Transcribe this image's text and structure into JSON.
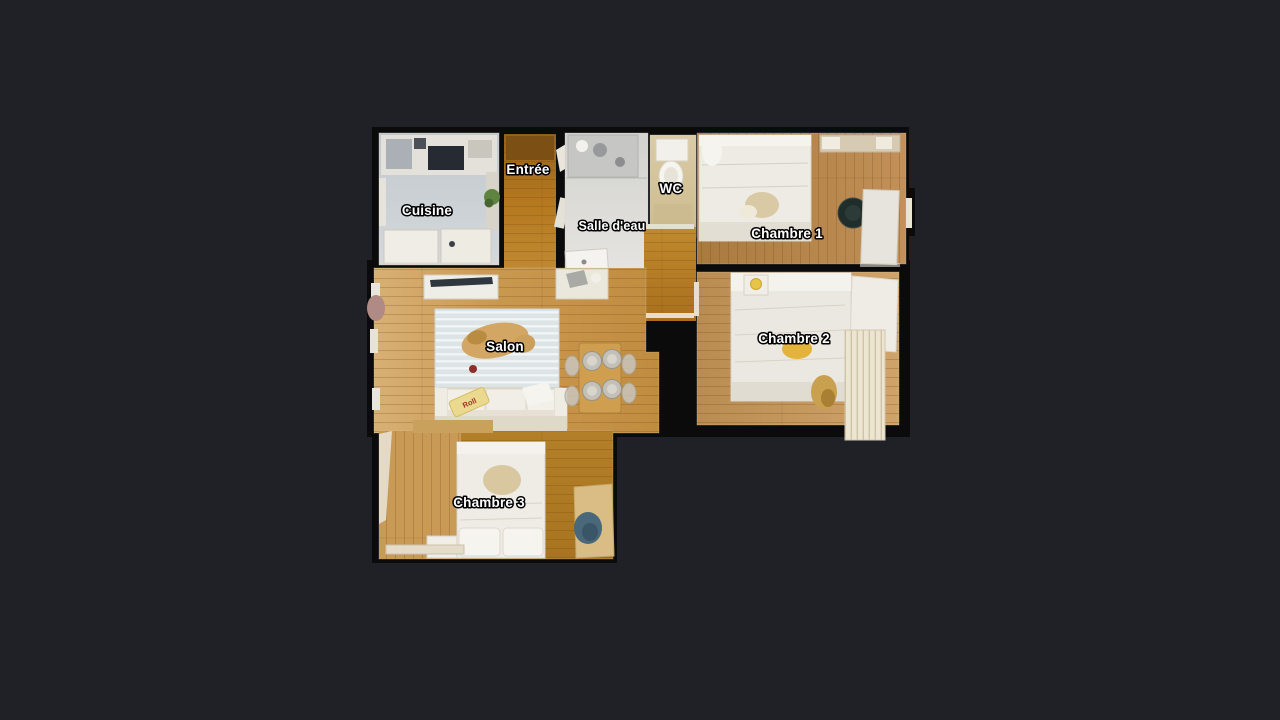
{
  "viewer": {
    "background_color": "#1f2126",
    "wall_color": "#0b0b0c"
  },
  "floorplan": {
    "rooms": [
      {
        "id": "cuisine",
        "label": "Cuisine"
      },
      {
        "id": "entree",
        "label": "Entrée"
      },
      {
        "id": "salle-deau",
        "label": "Salle d'eau"
      },
      {
        "id": "wc",
        "label": "WC"
      },
      {
        "id": "chambre-1",
        "label": "Chambre 1"
      },
      {
        "id": "chambre-2",
        "label": "Chambre 2"
      },
      {
        "id": "salon",
        "label": "Salon"
      },
      {
        "id": "chambre-3",
        "label": "Chambre 3"
      }
    ],
    "decor": {
      "sofa_pillow_text": "Roll"
    },
    "palette": {
      "background": "#1f2126",
      "walls": "#0b0b0c",
      "wood_entree": "#b5791f",
      "wood_salon": "#cd9d58",
      "wood_chambre1": "#b5803d",
      "wood_chambre2": "#c59a62",
      "wood_chambre3": "#b1812f",
      "kitchen_floor": "#c7cdd2",
      "bathroom_floor": "#dcdbd6",
      "wc_floor": "#d5c69e",
      "rug": "#e3e8e8",
      "label_text": "#ffffff",
      "label_outline": "#000000"
    }
  }
}
